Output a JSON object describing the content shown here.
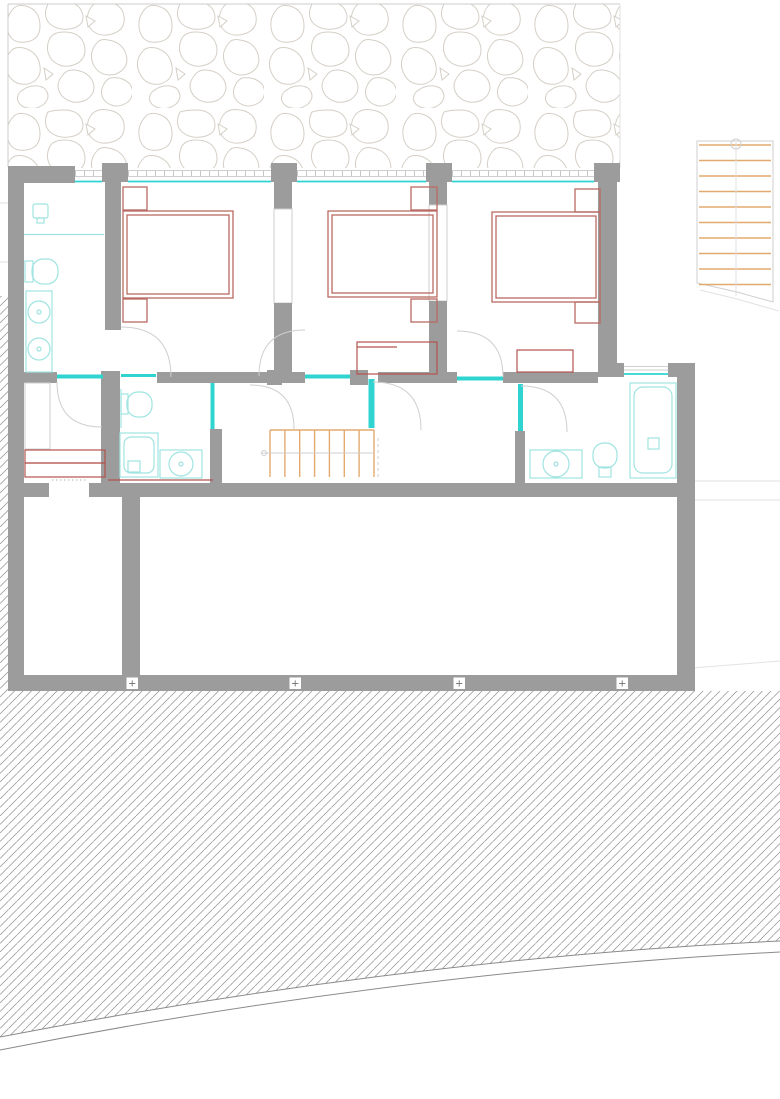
{
  "markers": {
    "symbol": "+",
    "count": 4
  },
  "stairs": {
    "interior_treads": 7,
    "exterior_treads": 10
  },
  "colors": {
    "wall": "#9c9c9c",
    "line": "#cfcfcf",
    "stone": "#d5cfc6",
    "hatchline": "#8f8f8f",
    "glass": "#2fd4d0",
    "fixture": "#9fe4e1",
    "furniture": "#b96a62",
    "furniture2": "#b2534d",
    "stair": "#e3aa70",
    "markertext": "#6f6f6f"
  }
}
